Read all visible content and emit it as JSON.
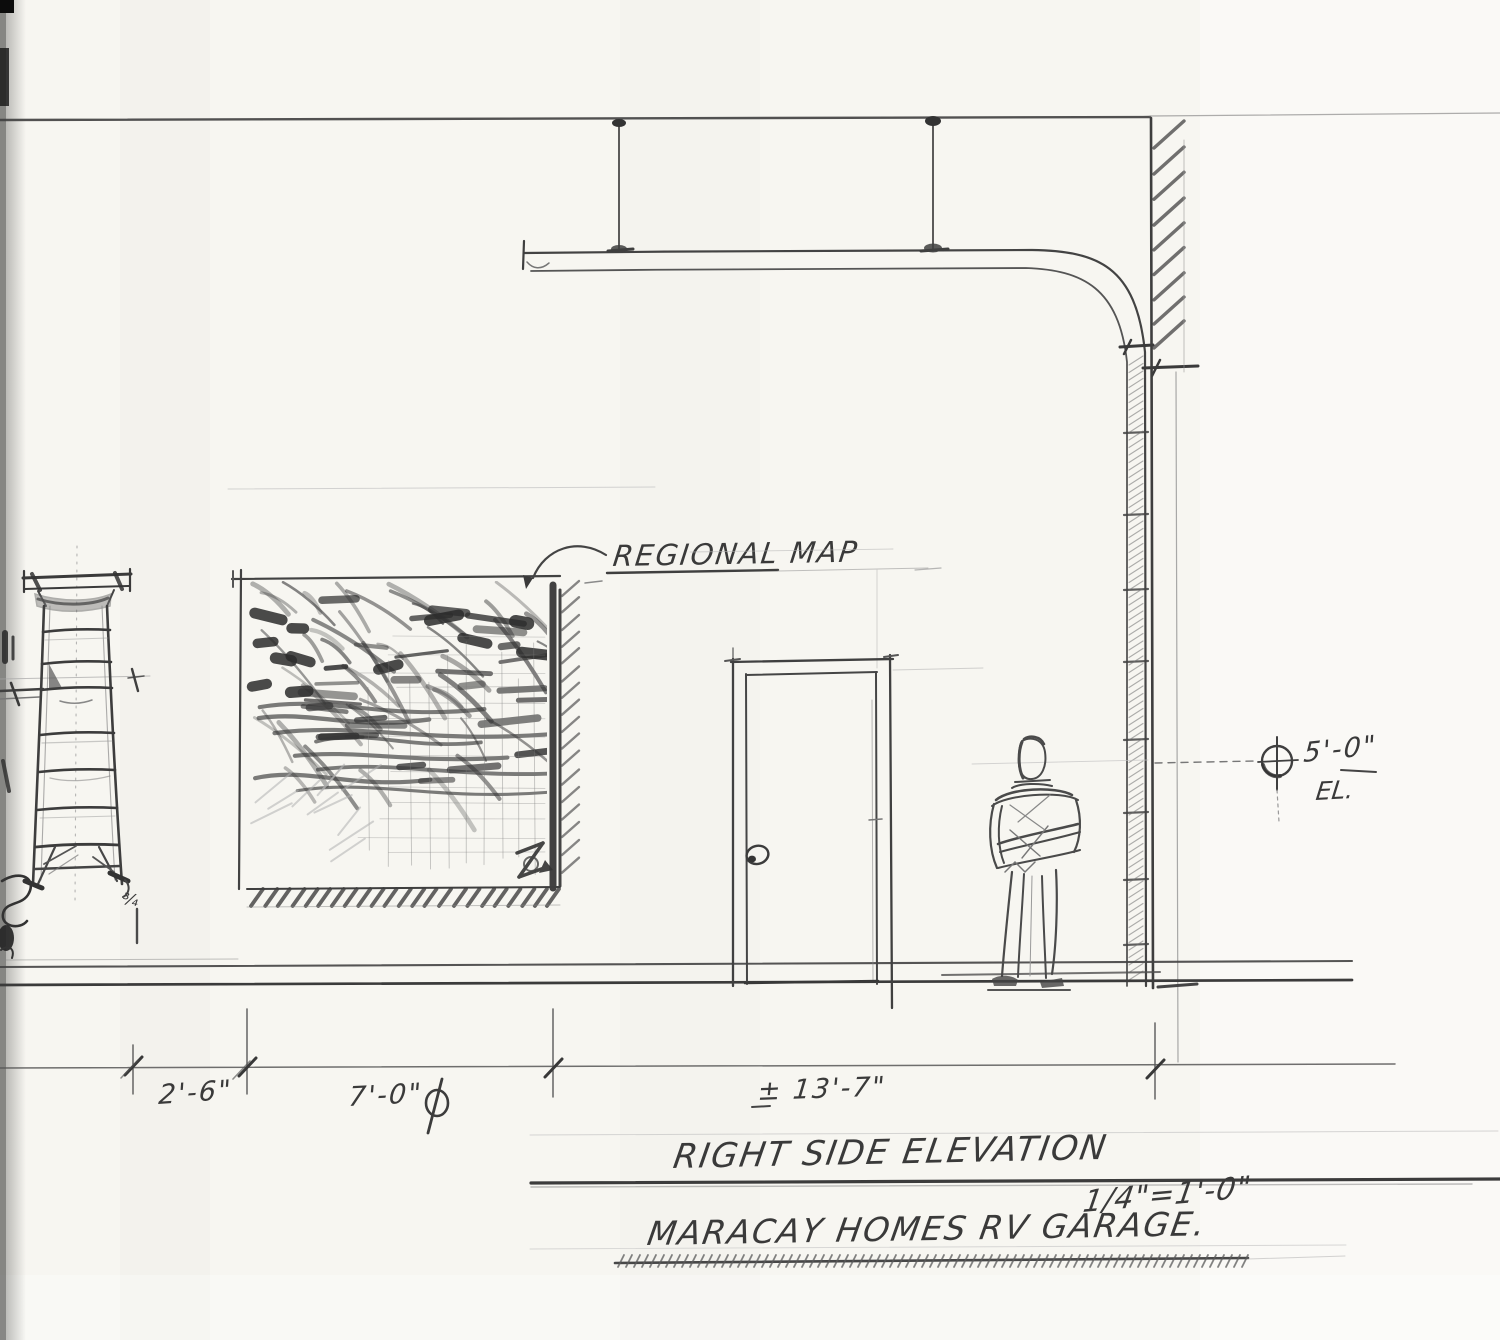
{
  "labels": {
    "regional_map": "REGIONAL MAP",
    "elevation": "5'-0\"",
    "elevation_suffix": "EL.",
    "ladder_mark": "¾"
  },
  "dimensions": {
    "d1": "2'-6\"",
    "d2": "7'-0\"",
    "d3": "± 13'-7\""
  },
  "title": {
    "name": "RIGHT SIDE ELEVATION",
    "scale": "1/4\"=1'-0\"",
    "project": "MARACAY HOMES RV GARAGE."
  },
  "symbols": {
    "after_d2": "diameter-mark",
    "elevation_marker": "benchmark-target-icon",
    "map_corner": "north-arrow-mark"
  },
  "colors": {
    "paper": "#f7f6f1",
    "pencil_dark": "#3a3a3a",
    "pencil_mid": "#666666",
    "pencil_light": "#b5b5b5"
  }
}
